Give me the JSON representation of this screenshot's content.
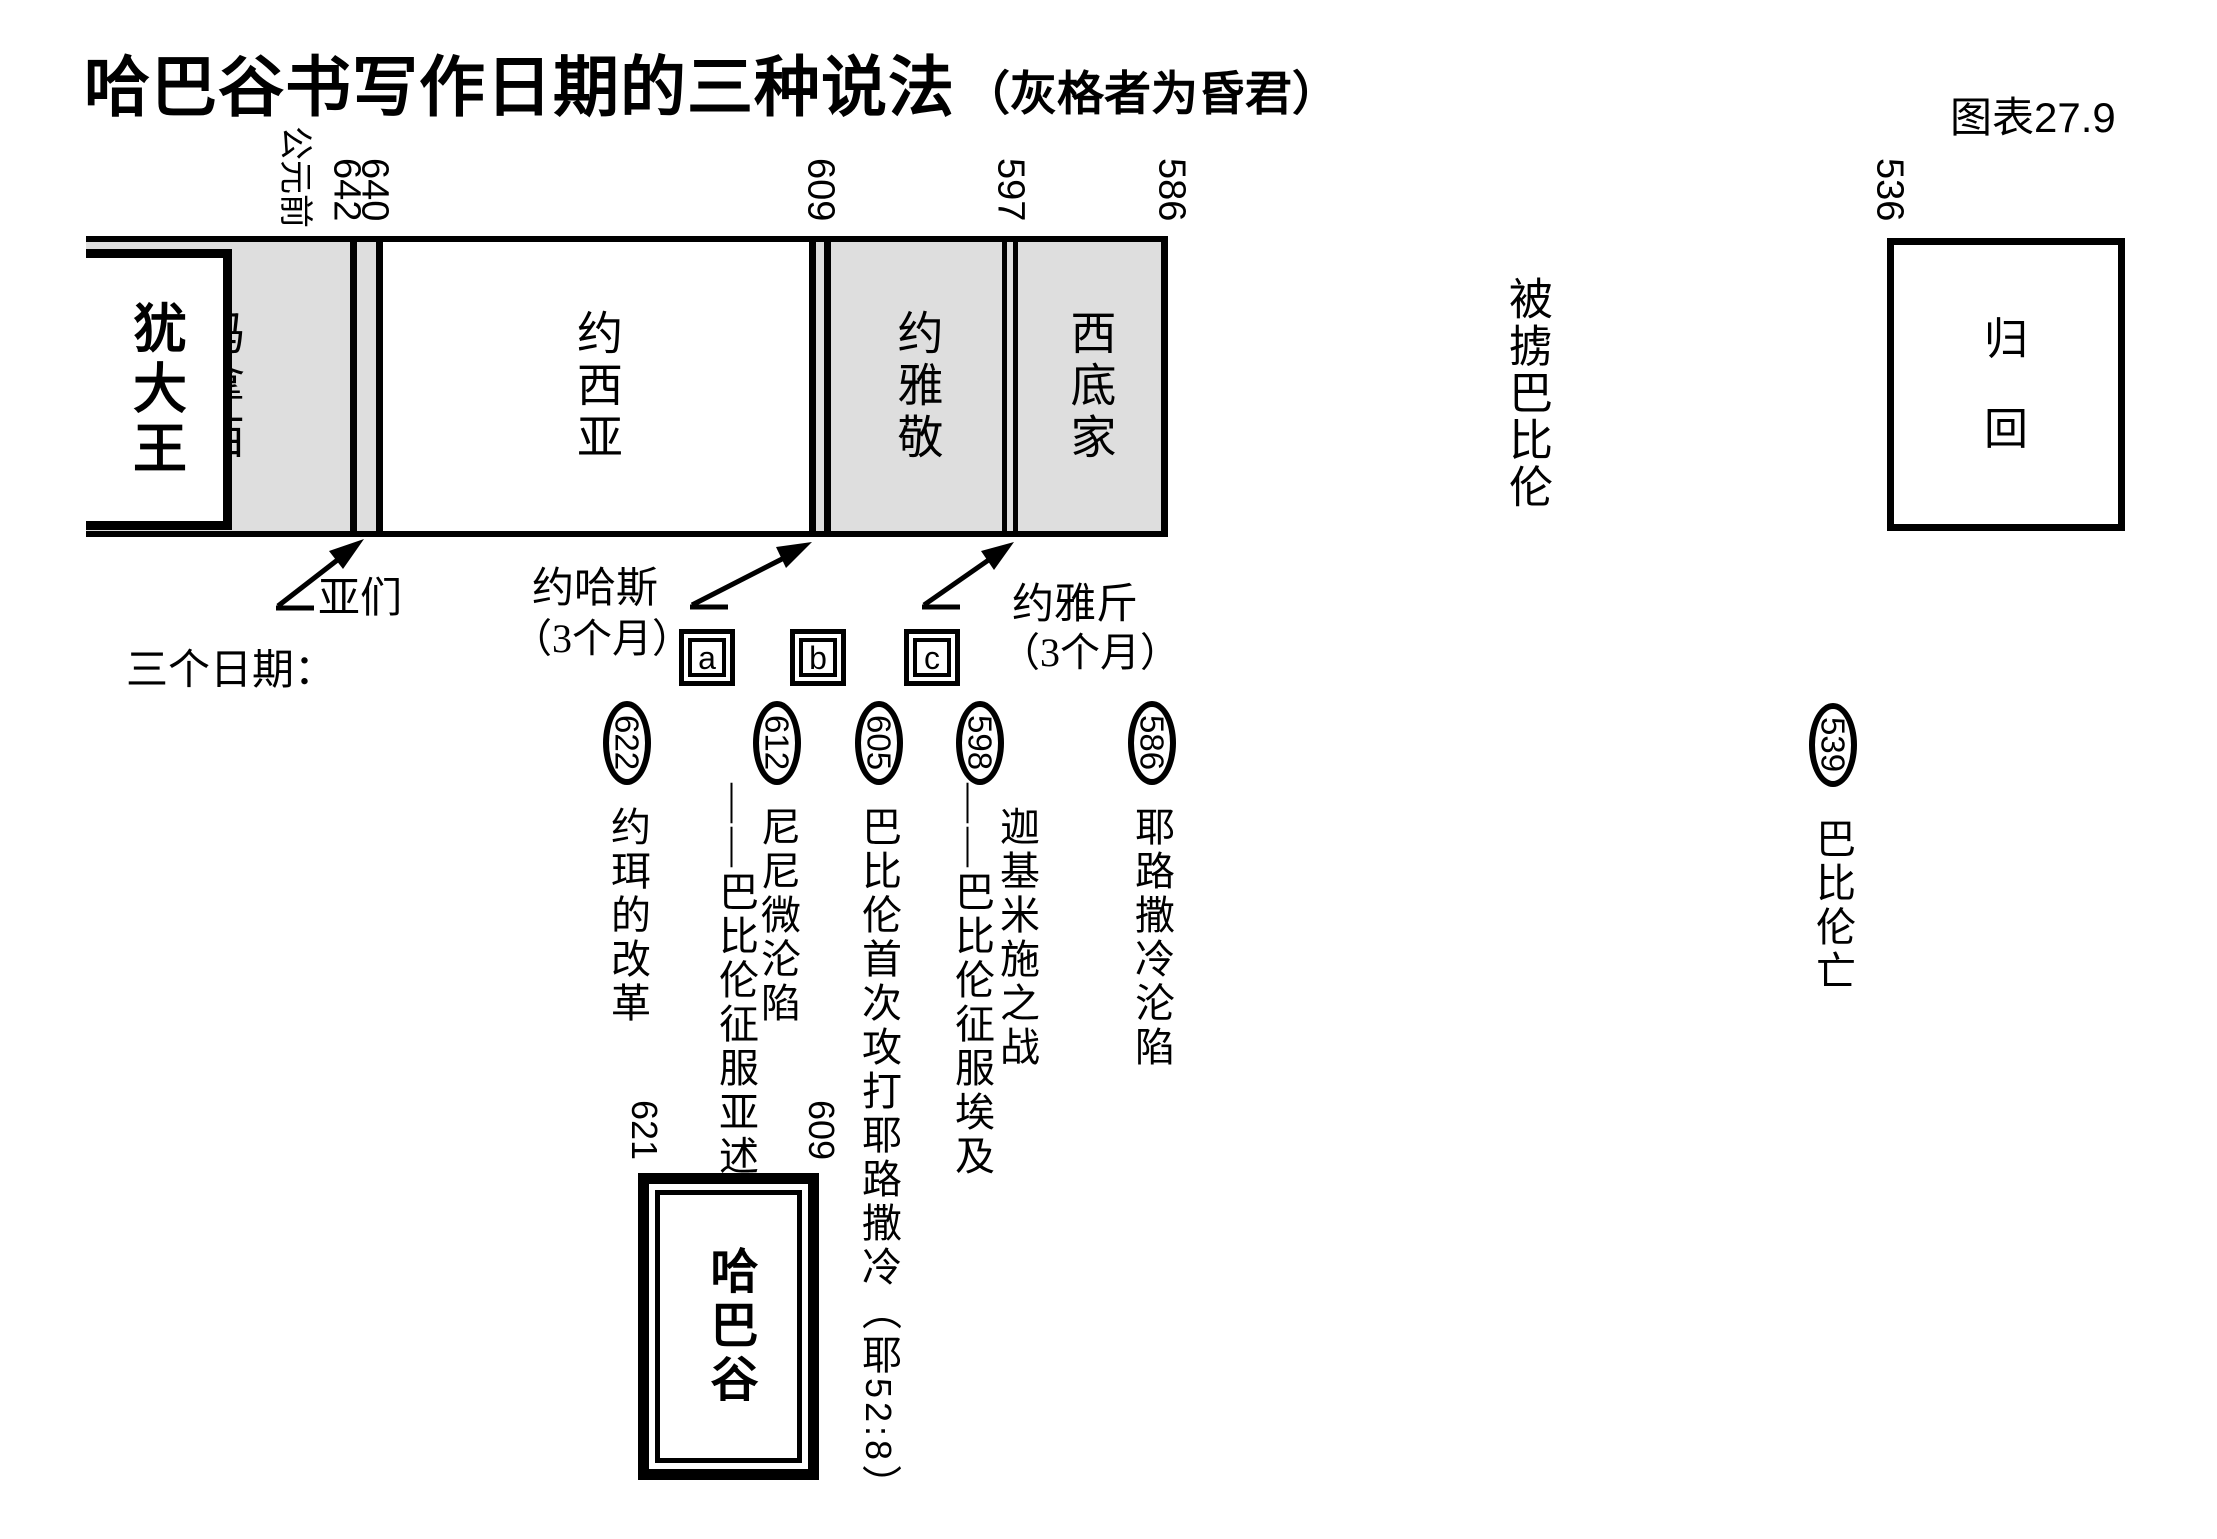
{
  "title": {
    "main": "哈巴谷书写作日期的三种说法",
    "note": "（灰格者为昏君）",
    "chart_no": "图表27.9"
  },
  "era_label": "公元前",
  "axis_years": [
    "642",
    "640",
    "609",
    "597",
    "586",
    "536"
  ],
  "kings_bar": {
    "header": "犹大王",
    "segments": [
      {
        "name": "玛拿西",
        "shade": "gray"
      },
      {
        "name": "约西亚",
        "shade": "white"
      },
      {
        "name": "约雅敬",
        "shade": "gray"
      },
      {
        "name": "西底家",
        "shade": "gray"
      }
    ],
    "strips": [
      {
        "name": "亚们",
        "note": ""
      },
      {
        "name": "约哈斯",
        "note": "（3个月）"
      },
      {
        "name": "约雅斤",
        "note": "（3个月）"
      }
    ],
    "exile_label": "被掳巴比伦",
    "return_label_char1": "归",
    "return_label_char2": "回"
  },
  "three_dates_label": "三个日期：",
  "options": [
    "a",
    "b",
    "c"
  ],
  "events": [
    {
      "year": "622",
      "line1": "约珥的改革",
      "line2": ""
    },
    {
      "year": "612",
      "line1": "尼尼微沦陷",
      "line2": "——巴比伦征服亚述"
    },
    {
      "year": "605",
      "line1": "巴比伦首次攻打耶路撒冷（耶",
      "ref_num": "52:8",
      "line1_end": "）",
      "line2": ""
    },
    {
      "year": "598",
      "line1": "迦基米施之战",
      "line2": "——巴比伦征服埃及"
    },
    {
      "year": "586",
      "line1": "耶路撒冷沦陷",
      "line2": ""
    },
    {
      "year": "539",
      "line1": "巴比伦亡",
      "line2": ""
    }
  ],
  "habakkuk": {
    "name": "哈巴谷",
    "from_year": "621",
    "to_year": "609"
  },
  "colors": {
    "evil_king_fill": "#dedede",
    "ink": "#000000",
    "paper": "#ffffff"
  }
}
